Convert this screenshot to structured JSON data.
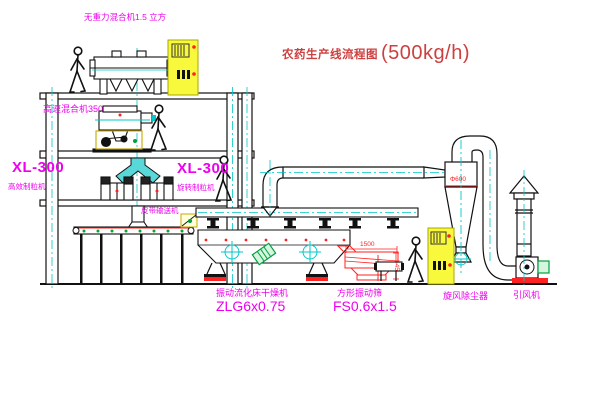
{
  "title": {
    "text": "农药生产线流程图",
    "capacity": "(500kg/h)"
  },
  "labels": {
    "gravity_mixer": "无重力混合机1.5 立方",
    "high_speed_mixer": "高速混合机350",
    "granulator_left_model": "XL-300",
    "granulator_left_name": "高效制粒机",
    "granulator_mid_model": "XL-300",
    "granulator_mid_name": "旋转制粒机",
    "belt_conveyor": "皮带输送机",
    "dryer_name": "振动流化床干燥机",
    "dryer_model": "ZLG6x0.75",
    "sieve_name": "方形振动筛",
    "sieve_model": "FS0.6x1.5",
    "cyclone": "旋风除尘器",
    "fan": "引风机"
  },
  "dimensions": {
    "sieve_length": "1500",
    "sieve_height": "545",
    "cyclone_diameter": "Φ600"
  },
  "colors": {
    "label_magenta": "#EE00EE",
    "title_red": "#CC4040",
    "dimension_red": "#FF2222",
    "centerline_cyan": "#00C8C8",
    "cabinet_yellow": "#F8F83C",
    "motor_green": "#00A040",
    "line_black": "#111111"
  },
  "icons": {
    "person": "walking-operator-figure",
    "cabinet": "electrical-control-cabinet",
    "centerline": "cyan-dash-dot-centerline"
  }
}
